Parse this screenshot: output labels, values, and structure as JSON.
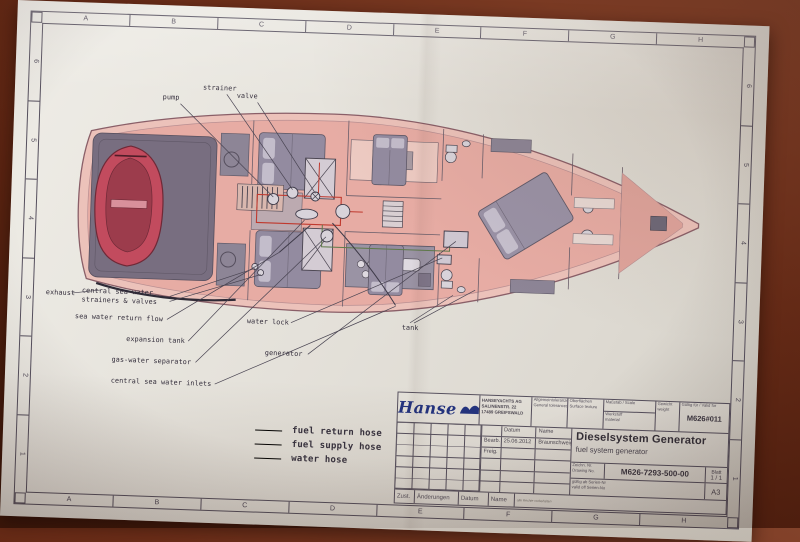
{
  "sheet": {
    "grid": {
      "letters": [
        "A",
        "B",
        "C",
        "D",
        "E",
        "F",
        "G",
        "H"
      ],
      "numbers": [
        "6",
        "5",
        "4",
        "3",
        "2",
        "1"
      ]
    },
    "labels": {
      "pump": "pump",
      "strainer": "strainer",
      "valve": "valve",
      "exhaust": "exhaust",
      "central_sea_water": "central sea water strainers & valves",
      "sea_water_return_flow": "sea water return flow",
      "expansion_tank": "expansion tank",
      "gas_water_separator": "gas-water separator",
      "central_sea_water_inlets": "central sea water inlets",
      "water_lock": "water lock",
      "generator": "generator",
      "tank": "tank"
    },
    "legend": {
      "items": [
        {
          "label": "fuel return hose",
          "color": "#73765a"
        },
        {
          "label": "fuel supply hose",
          "color": "#c4756a"
        },
        {
          "label": "water hose",
          "color": "#504e60"
        }
      ]
    },
    "title_block": {
      "logo": "Hanse",
      "company_lines": [
        "HANSEYACHTS AG",
        "SALINENSTR. 22",
        "17489 GREIFSWALD"
      ],
      "cells": {
        "tolerances_de": "Allgemeintoleranzen",
        "tolerances_en": "General tolerances",
        "surface_de": "Oberflächen",
        "surface_en": "Surface texture",
        "scale_de": "Maßstab",
        "scale_en": "Scale",
        "material_de": "Werkstoff",
        "material_en": "material",
        "weight_de": "Gewicht",
        "weight_en": "weight",
        "valid_for_de": "Gültig für",
        "valid_for_en": "Valid for",
        "doc_code": "M626#011"
      },
      "approval": {
        "datum": "Datum",
        "name": "Name",
        "bearb": "Bearb.",
        "freig": "Freig.",
        "bearb_date": "25.06.2012",
        "bearb_name": "Braunschweig"
      },
      "title_de": "Dieselsystem Generator",
      "title_en": "fuel system generator",
      "drawing_no_de": "Zeichn. Nr.",
      "drawing_no_en": "Drawing No.",
      "drawing_no": "M626-7293-500-00",
      "sheet_de": "Blatt",
      "sheet_value": "1 / 1",
      "valid_serial_de": "gültig ab Serien-Nr",
      "valid_serial_en": "valid off Serien-No",
      "format": "A3",
      "footer": {
        "zust": "Zust.",
        "aend": "Änderungen",
        "datum": "Datum",
        "name": "Name",
        "note": "alle Rechte vorbehalten"
      }
    }
  },
  "colors": {
    "table_brown": "#5c2411",
    "paper": "#e6e3dc",
    "hull_salmon": "#e7aca4",
    "furniture_gray": "#8d8596",
    "dinghy_red": "#c24b5e",
    "fuel_return_hose": "#73765a",
    "fuel_supply_hose": "#c4756a",
    "water_hose": "#504e60",
    "logo_blue": "#23337f"
  }
}
